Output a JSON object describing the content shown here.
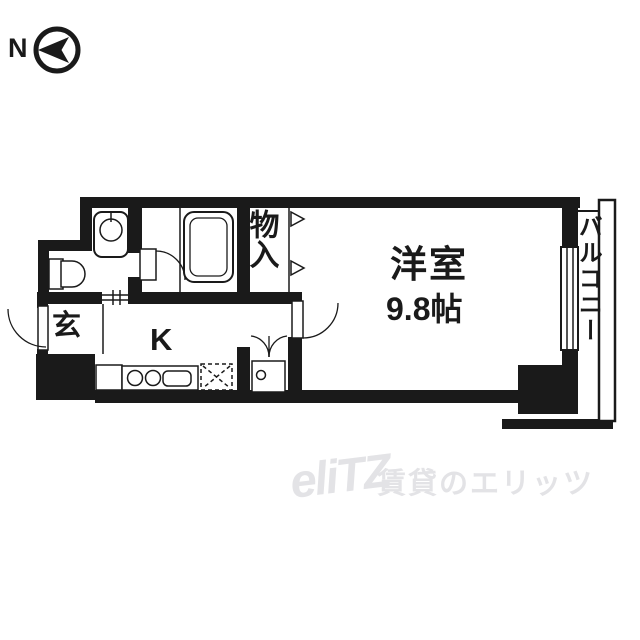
{
  "compass": {
    "north_label": "N"
  },
  "floorplan": {
    "rooms": {
      "genkan": "玄",
      "kitchen": "K",
      "closet": "物入",
      "western_room_name": "洋室",
      "western_room_size": "9.8帖",
      "balcony": "バルコニー"
    },
    "fixtures": [
      "washbasin",
      "toilet",
      "bathtub",
      "stove-burners",
      "kitchen-sink",
      "washing-machine-space",
      "washing-machine-pan",
      "sliding-window",
      "balcony-railing"
    ]
  },
  "watermark": {
    "logo": "eliTZ",
    "text": "賃貸のエリッツ"
  },
  "colors": {
    "wall": "#1a1a1a",
    "background": "#ffffff",
    "watermark": "#e3e3e6"
  }
}
